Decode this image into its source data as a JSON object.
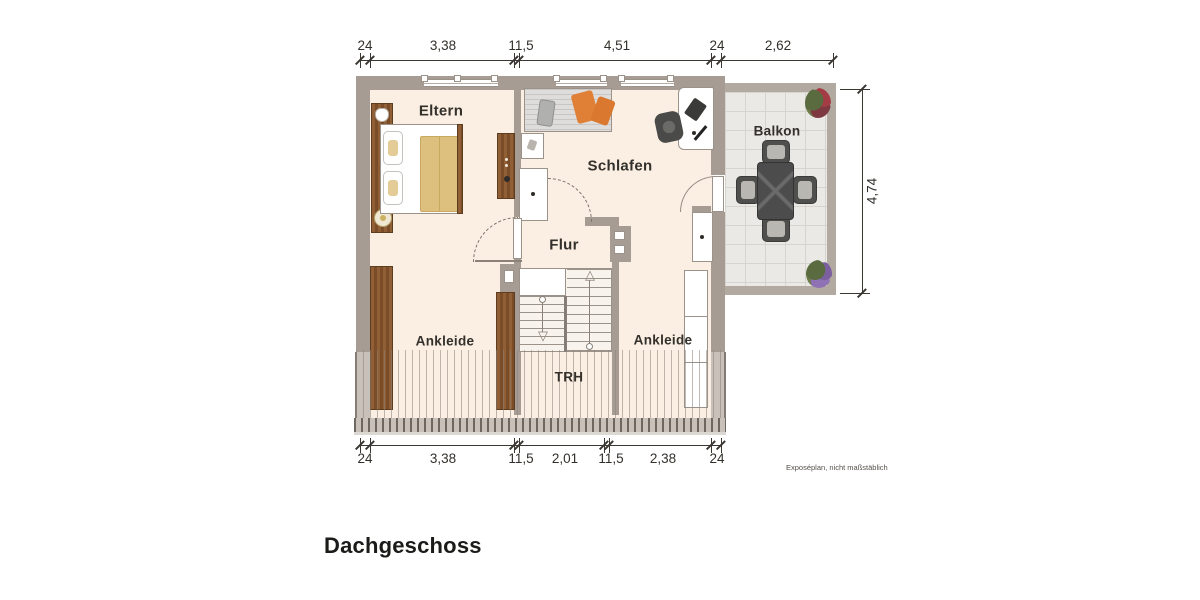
{
  "title": "Dachgeschoss",
  "footnote": "Exposéplan, nicht maßstäblich",
  "rooms": {
    "eltern": "Eltern",
    "schlafen": "Schlafen",
    "flur": "Flur",
    "ankleide_left": "Ankleide",
    "ankleide_right": "Ankleide",
    "trh": "TRH",
    "balkon": "Balkon"
  },
  "dims": {
    "top": [
      "24",
      "3,38",
      "11,5",
      "4,51",
      "24",
      "2,62"
    ],
    "bottom": [
      "24",
      "3,38",
      "11,5",
      "2,01",
      "11,5",
      "2,38",
      "24"
    ],
    "right": "4,74"
  },
  "colors": {
    "wall": "#a69c93",
    "wall_low": "#c7c1b9",
    "floor": "#faefe2",
    "balcony_tile": "#eae9e5",
    "wood": "#8a5c36",
    "accent_orange": "#e08036",
    "text": "#33302c"
  }
}
